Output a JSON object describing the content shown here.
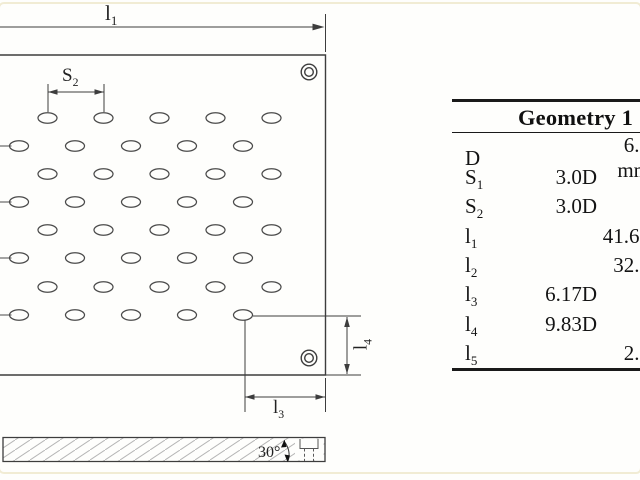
{
  "frame": {
    "border_color": "#f1ecd4"
  },
  "drawing": {
    "labels": {
      "l1": {
        "base": "l",
        "sub": "1"
      },
      "s2": {
        "base": "S",
        "sub": "2"
      },
      "l3": {
        "base": "l",
        "sub": "3"
      },
      "l4": {
        "base": "l",
        "sub": "4"
      },
      "angle": "30°"
    },
    "hole_pattern": {
      "rows": 8,
      "cols": 5,
      "row_ys": [
        118,
        146,
        174,
        202,
        230,
        258,
        287,
        315
      ],
      "first_row_x": 47.5,
      "offset_row_x": 19,
      "col_spacing": 56,
      "rx": 9.5,
      "ry": 5.2,
      "stub_len": 11.5
    }
  },
  "table": {
    "title": "Geometry 1",
    "rows": [
      {
        "param": "D",
        "sub": "",
        "rel": "",
        "abs": "6.0 mm"
      },
      {
        "param": "S",
        "sub": "1",
        "rel": "3.0D",
        "abs": ""
      },
      {
        "param": "S",
        "sub": "2",
        "rel": "3.0D",
        "abs": ""
      },
      {
        "param": "l",
        "sub": "1",
        "rel": "",
        "abs": "41.67"
      },
      {
        "param": "l",
        "sub": "2",
        "rel": "",
        "abs": "32.0"
      },
      {
        "param": "l",
        "sub": "3",
        "rel": "6.17D",
        "abs": ""
      },
      {
        "param": "l",
        "sub": "4",
        "rel": "9.83D",
        "abs": ""
      },
      {
        "param": "l",
        "sub": "5",
        "rel": "",
        "abs": "2.5"
      }
    ]
  }
}
